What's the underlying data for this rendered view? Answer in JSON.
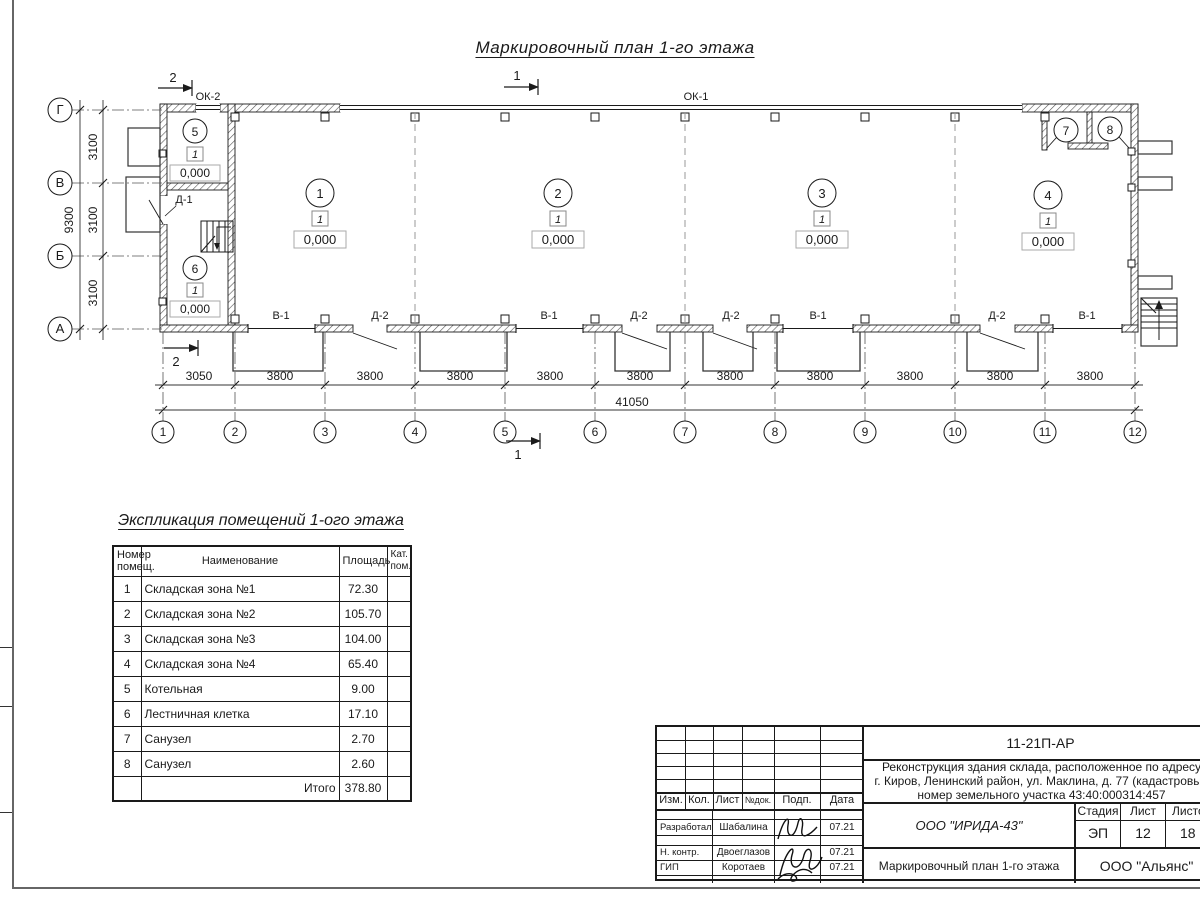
{
  "sheet_title": "Маркировочный план 1-го этажа",
  "plan": {
    "columns": [
      "1",
      "2",
      "3",
      "4",
      "5",
      "6",
      "7",
      "8",
      "9",
      "10",
      "11",
      "12"
    ],
    "rows": [
      "Г",
      "В",
      "Б",
      "А"
    ],
    "dims_bottom": [
      "3050",
      "3800",
      "3800",
      "3800",
      "3800",
      "3800",
      "3800",
      "3800",
      "3800",
      "3800",
      "3800"
    ],
    "dim_total": "41050",
    "dims_left": [
      "3100",
      "3100",
      "3100"
    ],
    "dim_left_total": "9300",
    "openings": [
      "В-1",
      "Д-2",
      "В-1",
      "Д-2",
      "Д-2",
      "В-1",
      "Д-2",
      "В-1"
    ],
    "window_ok1": "ОК-1",
    "window_ok2": "ОК-2",
    "door_d1": "Д-1",
    "section_1": "1",
    "section_2": "2",
    "room_numbers": [
      "1",
      "2",
      "3",
      "4",
      "5",
      "6",
      "7",
      "8"
    ],
    "level": "1",
    "elevation": "0,000"
  },
  "explication": {
    "title": "Экспликация помещений 1-ого этажа",
    "headers": [
      "Номер помещ.",
      "Наименование",
      "Площадь",
      "Кат. пом."
    ],
    "rows": [
      [
        "1",
        "Складская зона №1",
        "72.30",
        ""
      ],
      [
        "2",
        "Складская зона №2",
        "105.70",
        ""
      ],
      [
        "3",
        "Складская зона №3",
        "104.00",
        ""
      ],
      [
        "4",
        "Складская зона №4",
        "65.40",
        ""
      ],
      [
        "5",
        "Котельная",
        "9.00",
        ""
      ],
      [
        "6",
        "Лестничная клетка",
        "17.10",
        ""
      ],
      [
        "7",
        "Санузел",
        "2.70",
        ""
      ],
      [
        "8",
        "Санузел",
        "2.60",
        ""
      ]
    ],
    "total_label": "Итого",
    "total_value": "378.80"
  },
  "title_block": {
    "code": "11-21П-АР",
    "project_line1": "Реконструкция здания склада, расположенное по адресу",
    "project_line2": "г. Киров, Ленинский район, ул. Маклина, д. 77 (кадастровый",
    "project_line3": "номер земельного участка 43:40:000314:457",
    "col_izm": "Изм.",
    "col_kol": "Кол.",
    "col_list": "Лист",
    "col_ndok": "№док.",
    "col_podp": "Подп.",
    "col_data": "Дата",
    "people": [
      {
        "role": "Разработал",
        "name": "Шабалина",
        "date": "07.21"
      },
      {
        "role": "Н. контр.",
        "name": "Двоеглазов",
        "date": "07.21"
      },
      {
        "role": "ГИП",
        "name": "Коротаев",
        "date": "07.21"
      }
    ],
    "org": "ООО \"ИРИДА-43\"",
    "stage_label": "Стадия",
    "sheet_label": "Лист",
    "sheets_label": "Листов",
    "stage": "ЭП",
    "sheet": "12",
    "sheets": "18",
    "doc_title": "Маркировочный план 1-го этажа",
    "company": "ООО \"Альянс\""
  }
}
